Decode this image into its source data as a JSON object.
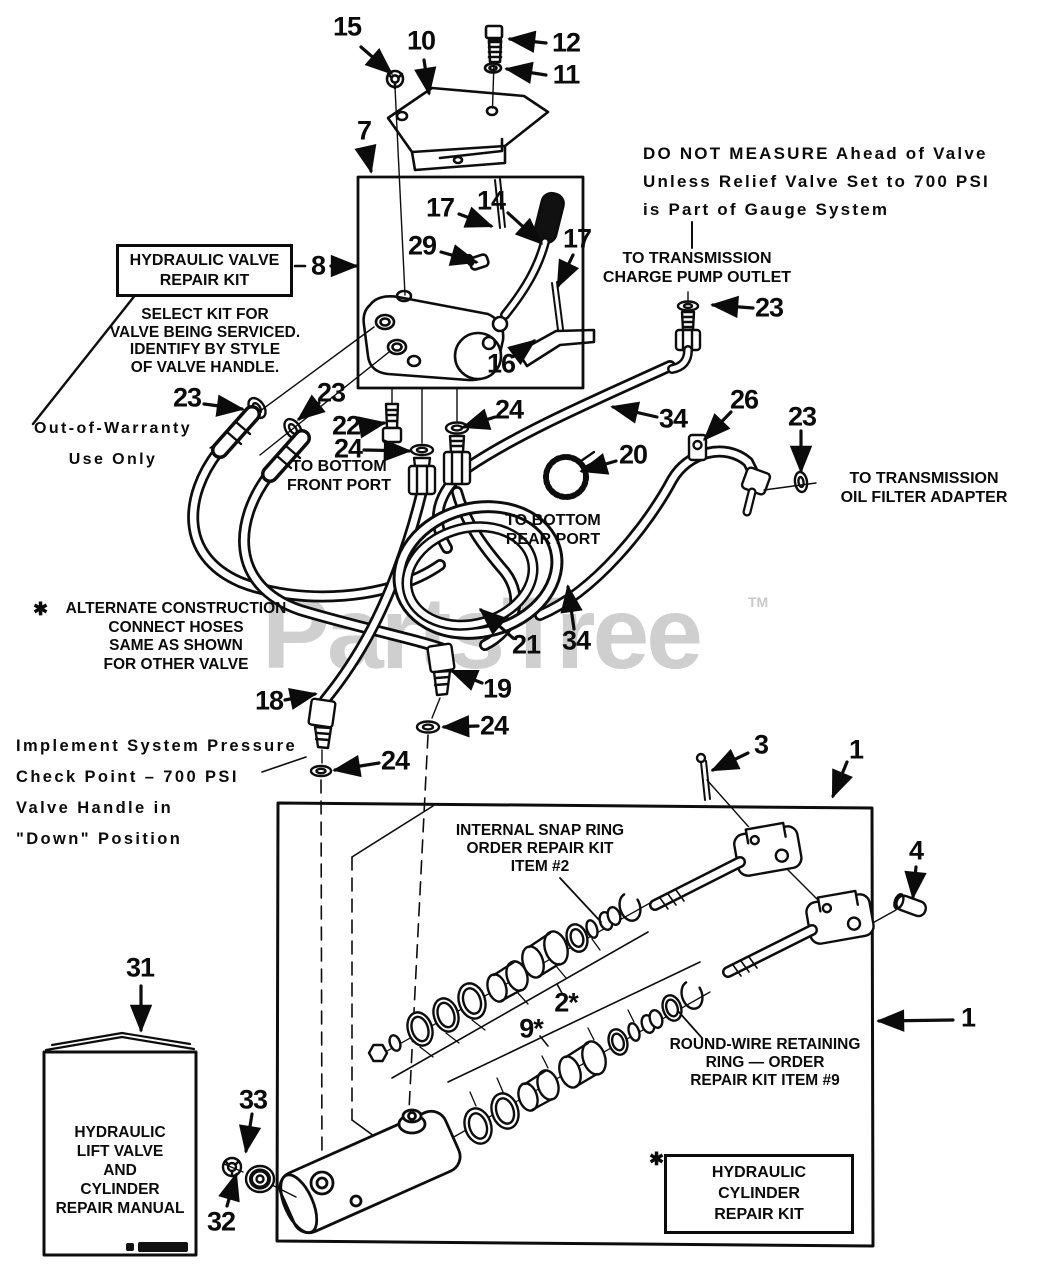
{
  "watermark": {
    "text": "PartsTree",
    "tm": "TM",
    "color": "#cfcfcf"
  },
  "labels": {
    "warning": {
      "l1": "DO NOT MEASURE Ahead of Valve",
      "l2": "Unless Relief Valve Set to 700 PSI",
      "l3": "is Part of Gauge System"
    },
    "charge_outlet": {
      "l1": "TO TRANSMISSION",
      "l2": "CHARGE PUMP OUTLET"
    },
    "valve_kit_box": {
      "l1": "HYDRAULIC VALVE",
      "l2": "REPAIR KIT"
    },
    "select_kit": {
      "l1": "SELECT KIT FOR",
      "l2": "VALVE BEING SERVICED.",
      "l3": "IDENTIFY BY STYLE",
      "l4": "OF VALVE HANDLE."
    },
    "warranty": {
      "l1": "Out-of-Warranty",
      "l2": "Use Only"
    },
    "front_port": {
      "l1": "TO BOTTOM",
      "l2": "FRONT PORT"
    },
    "rear_port": {
      "l1": "TO BOTTOM",
      "l2": "REAR PORT"
    },
    "oil_filter": {
      "l1": "TO TRANSMISSION",
      "l2": "OIL FILTER ADAPTER"
    },
    "alternate": {
      "star": "✱",
      "l1": "ALTERNATE CONSTRUCTION",
      "l2": "CONNECT HOSES",
      "l3": "SAME AS SHOWN",
      "l4": "FOR OTHER VALVE"
    },
    "implement": {
      "l1": "Implement System Pressure",
      "l2": "Check Point – 700 PSI",
      "l3": "Valve Handle in",
      "l4": "\"Down\" Position"
    },
    "snap_ring": {
      "l1": "INTERNAL SNAP RING",
      "l2": "ORDER REPAIR KIT",
      "l3": "ITEM #2"
    },
    "round_wire": {
      "l1": "ROUND-WIRE RETAINING",
      "l2": "RING — ORDER",
      "l3": "REPAIR KIT ITEM #9"
    },
    "manual": {
      "l1": "HYDRAULIC",
      "l2": "LIFT VALVE",
      "l3": "AND",
      "l4": "CYLINDER",
      "l5": "REPAIR MANUAL"
    },
    "cyl_kit": {
      "star": "✱",
      "l1": "HYDRAULIC",
      "l2": "CYLINDER",
      "l3": "REPAIR KIT"
    }
  },
  "callouts": [
    {
      "n": "15"
    },
    {
      "n": "10"
    },
    {
      "n": "12"
    },
    {
      "n": "11"
    },
    {
      "n": "7"
    },
    {
      "n": "17"
    },
    {
      "n": "14"
    },
    {
      "n": "29"
    },
    {
      "n": "17"
    },
    {
      "n": "8"
    },
    {
      "n": "16"
    },
    {
      "n": "23"
    },
    {
      "n": "23"
    },
    {
      "n": "22"
    },
    {
      "n": "24"
    },
    {
      "n": "24"
    },
    {
      "n": "20"
    },
    {
      "n": "34"
    },
    {
      "n": "26"
    },
    {
      "n": "23"
    },
    {
      "n": "23"
    },
    {
      "n": "21"
    },
    {
      "n": "34"
    },
    {
      "n": "18"
    },
    {
      "n": "19"
    },
    {
      "n": "24"
    },
    {
      "n": "24"
    },
    {
      "n": "3"
    },
    {
      "n": "1"
    },
    {
      "n": "4"
    },
    {
      "n": "1"
    },
    {
      "n": "31"
    },
    {
      "n": "33"
    },
    {
      "n": "32"
    },
    {
      "n": "2*"
    },
    {
      "n": "9*"
    }
  ]
}
